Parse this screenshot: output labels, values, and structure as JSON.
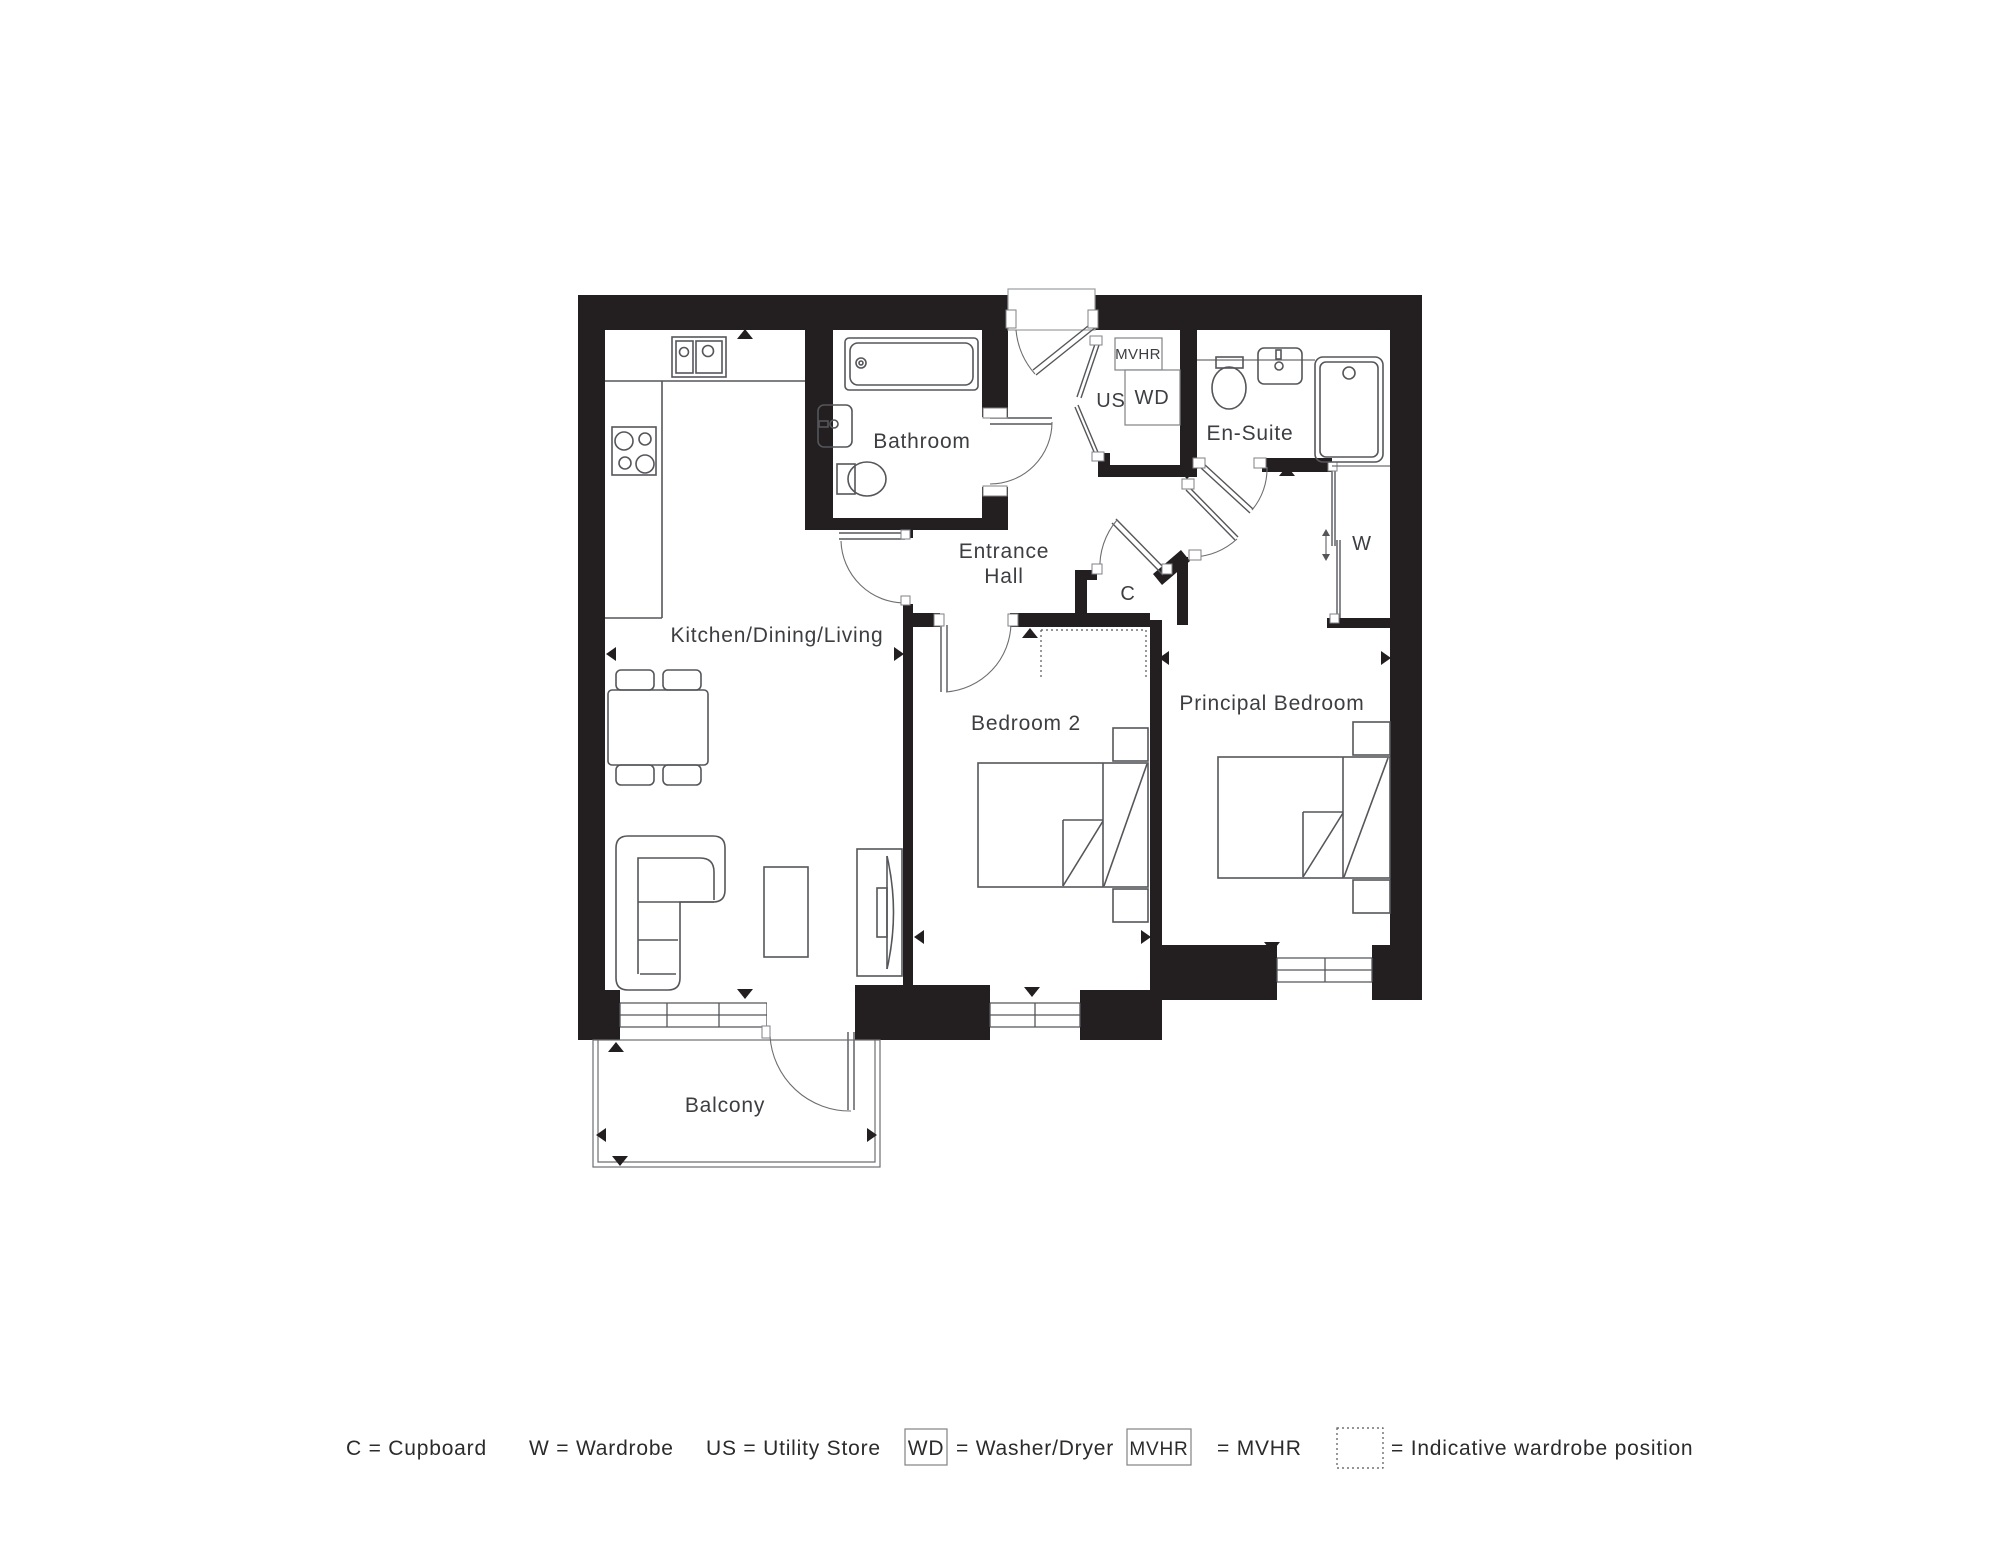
{
  "plan": {
    "labels": {
      "kitchen": "Kitchen/Dining/Living",
      "bathroom": "Bathroom",
      "entrance_line1": "Entrance",
      "entrance_line2": "Hall",
      "ensuite": "En-Suite",
      "bedroom2": "Bedroom 2",
      "principal": "Principal Bedroom",
      "balcony": "Balcony",
      "cupboard": "C",
      "wardrobe": "W",
      "utility_store": "US",
      "washer_dryer": "WD",
      "mvhr": "MVHR"
    }
  },
  "legend": {
    "cupboard": "C = Cupboard",
    "wardrobe": "W = Wardrobe",
    "utility_store": "US = Utility Store",
    "wd_symbol": "WD",
    "wd_label": "= Washer/Dryer",
    "mvhr_symbol": "MVHR",
    "mvhr_label": "= MVHR",
    "indicative_label": "= Indicative wardrobe position"
  },
  "colors": {
    "wall": "#231f20",
    "line": "#55565a",
    "text": "#3d3e42",
    "background": "#ffffff"
  }
}
